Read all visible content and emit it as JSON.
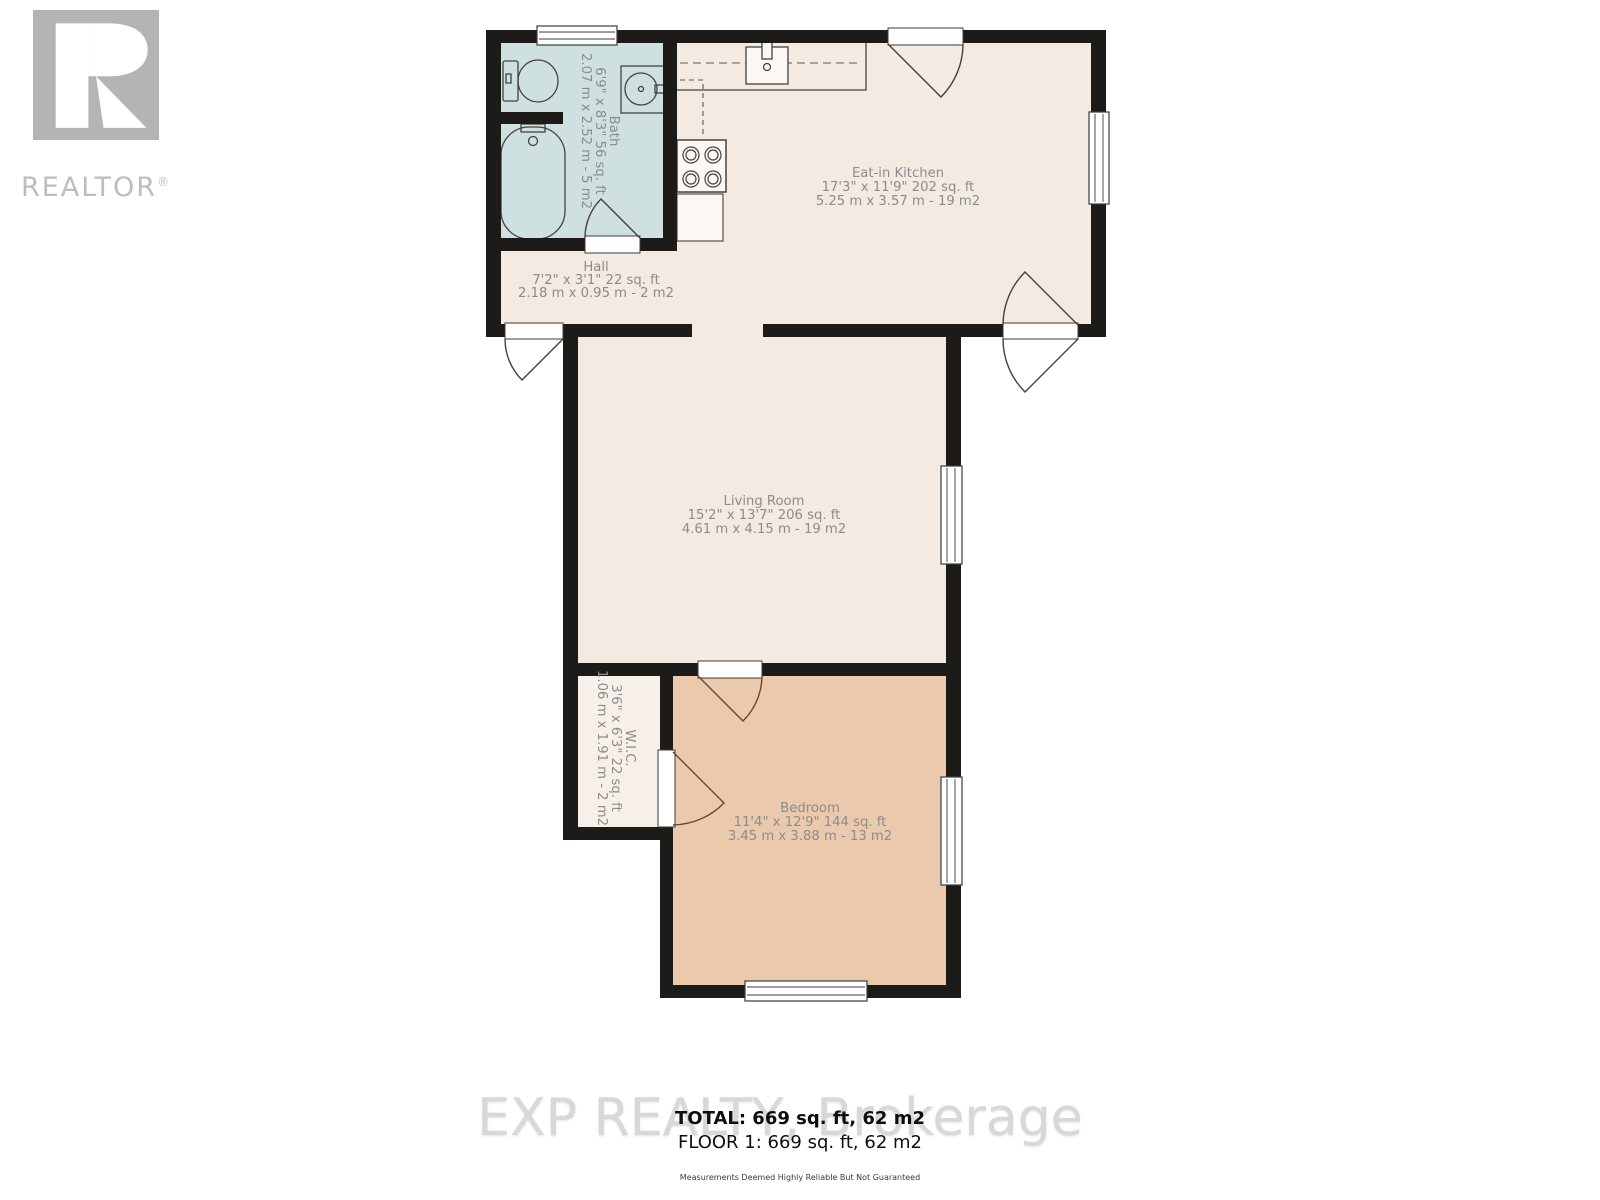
{
  "logo": {
    "letter_icon": "realtor-r-icon",
    "word": "REALTOR",
    "reg": "®"
  },
  "rooms": {
    "bath": {
      "name": "Bath",
      "imperial": "6'9\" x 8'3\" 56 sq. ft",
      "metric": "2.07 m x 2.52 m - 5 m2"
    },
    "kitchen": {
      "name": "Eat-in Kitchen",
      "imperial": "17'3\" x 11'9\" 202 sq. ft",
      "metric": "5.25 m x 3.57 m - 19 m2"
    },
    "hall": {
      "name": "Hall",
      "imperial": "7'2\" x 3'1\" 22 sq. ft",
      "metric": "2.18 m x 0.95 m - 2 m2"
    },
    "living": {
      "name": "Living Room",
      "imperial": "15'2\" x 13'7\" 206 sq. ft",
      "metric": "4.61 m x 4.15 m - 19 m2"
    },
    "wic": {
      "name": "W.I.C.",
      "imperial": "3'6\" x 6'3\" 22 sq. ft",
      "metric": "1.06 m x 1.91 m - 2 m2"
    },
    "bedroom": {
      "name": "Bedroom",
      "imperial": "11'4\" x 12'9\" 144 sq. ft",
      "metric": "3.45 m x 3.88 m - 13 m2"
    }
  },
  "summary": {
    "total": "TOTAL: 669 sq. ft, 62 m2",
    "floor": "FLOOR 1: 669 sq. ft, 62 m2",
    "disclaimer": "Measurements Deemed Highly Reliable But Not Guaranteed"
  },
  "watermark": "EXP REALTY, Brokerage",
  "colors": {
    "wall": "#1d1b18",
    "floor": "#f3eae2",
    "bath": "#cfe0e0",
    "bedroom": "#ebc9ad",
    "wic": "#f6f0e9",
    "label": "#8c8c8c",
    "logo_gray": "#b4b4b4",
    "watermark_gray": "#d8d8d8",
    "door_arc": "#4a4038",
    "door_arc_brown": "#6a4730"
  }
}
